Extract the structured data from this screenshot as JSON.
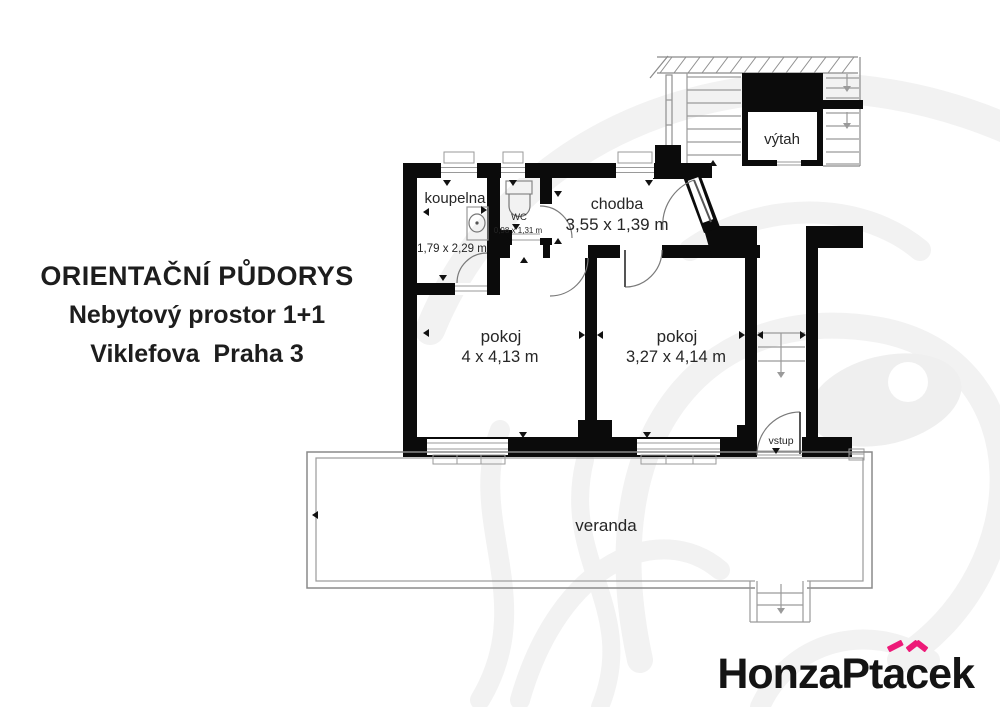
{
  "title_block": {
    "line1": "ORIENTAČNÍ PŮDORYS",
    "line2": "Nebytový prostor 1+1",
    "line3": "Viklefova  Praha 3"
  },
  "plan": {
    "rooms": {
      "koupelna": {
        "label": "koupelna",
        "dims": "1,79 x 2,29 m"
      },
      "wc": {
        "label": "WC",
        "dims": "0,98 x 1,31 m"
      },
      "chodba": {
        "label": "chodba",
        "dims": "3,55 x 1,39 m"
      },
      "pokoj_left": {
        "label": "pokoj",
        "dims": "4 x 4,13 m"
      },
      "pokoj_right": {
        "label": "pokoj",
        "dims": "3,27 x 4,14 m"
      },
      "vytah": {
        "label": "výtah"
      },
      "vstup": {
        "label": "vstup"
      },
      "veranda": {
        "label": "veranda"
      }
    }
  },
  "branding": {
    "logo_full": "HonzaPtáček",
    "logo_part1": "HonzaPt",
    "logo_a": "a",
    "logo_c": "c",
    "logo_part2": "ek"
  },
  "colors": {
    "wall": "#0b0b0b",
    "thin_line": "#9a9a9a",
    "door_arc": "#7a7a7a",
    "text": "#262626",
    "accent_pink": "#ed1a78",
    "watermark": "#f2f2f2"
  }
}
